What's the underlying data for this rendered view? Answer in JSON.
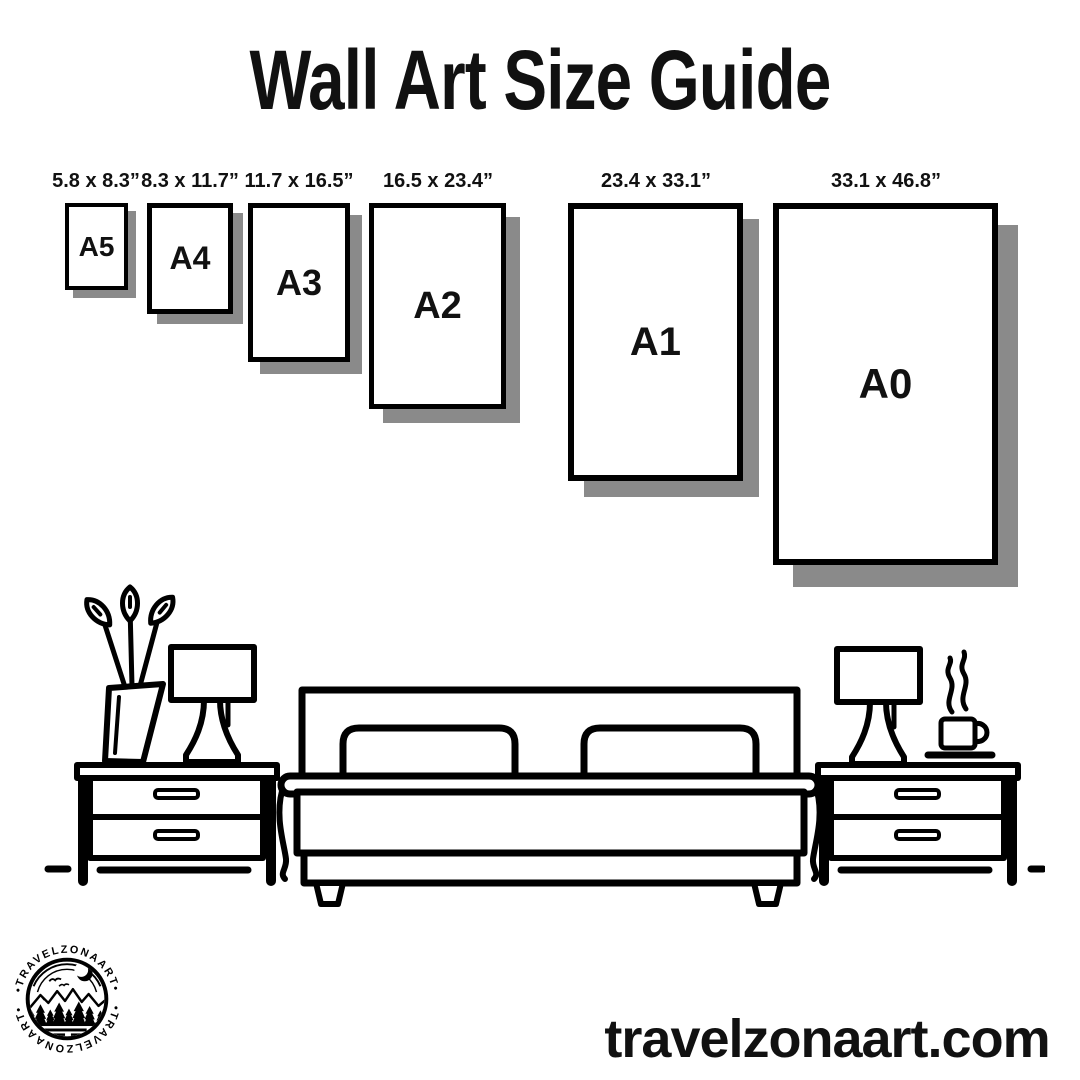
{
  "title": "Wall Art Size Guide",
  "sizes": [
    {
      "code": "A5",
      "dimensions": "5.8 x 8.3”"
    },
    {
      "code": "A4",
      "dimensions": "8.3 x 11.7”"
    },
    {
      "code": "A3",
      "dimensions": "11.7 x 16.5”"
    },
    {
      "code": "A2",
      "dimensions": "16.5 x 23.4”"
    },
    {
      "code": "A1",
      "dimensions": "23.4 x 33.1”"
    },
    {
      "code": "A0",
      "dimensions": "33.1 x 46.8”"
    }
  ],
  "logo": {
    "arc_text": "•TRAVELZONAART•",
    "brand": "TRAVELZONAART"
  },
  "footer": {
    "website": "travelzonaart.com"
  },
  "colors": {
    "ink": "#000000",
    "background": "#ffffff",
    "frame_shadow": "#8a8a8a"
  }
}
